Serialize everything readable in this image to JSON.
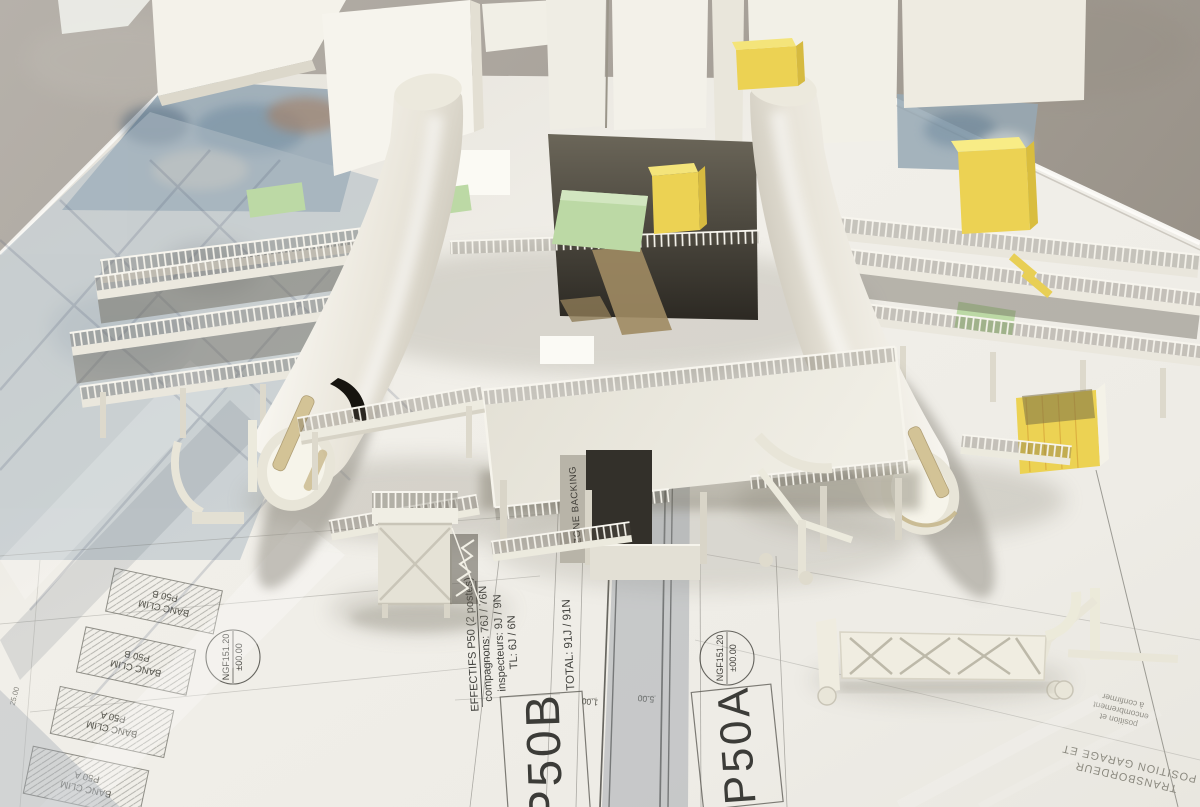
{
  "blueprint": {
    "effectifs": {
      "title": "EFFECTIFS P50 (2 postes)",
      "compagnons": "compagnons: 76J / 76N",
      "inspecteurs": "inspecteurs: 9J / 9N",
      "tl": "TL: 6J / 6N",
      "total": "TOTAL: 91J / 91N"
    },
    "station_b": "P50B",
    "station_a": "P50A",
    "level_stamp": {
      "line1": "NGF151.20",
      "line2": "±00.00"
    },
    "zone_label": "ZONE BACKING",
    "banc_clim": {
      "b_line1": "BANC CLIM",
      "b_line2": "P50 B",
      "a_line1": "BANC CLIM",
      "a_line2": "P50 A"
    },
    "note_position": {
      "line1": "position et",
      "line2": "encombrement",
      "line3": "à confirmer"
    },
    "note_garage": {
      "top": "POSITION GARAGE ET",
      "bottom": "TRANSBORDEUR"
    },
    "dims": {
      "d1": "1.00",
      "d2": "5.00",
      "d3": "25.00"
    }
  },
  "colors": {
    "paper": "#efede6",
    "floor": "#aba49c",
    "ink": "#4a4943",
    "fuselage_white": "#f5f3eb",
    "crate_yellow": "#ecd253",
    "mat_green": "#bcd9a5",
    "scaffold_white": "#f1efe5"
  }
}
